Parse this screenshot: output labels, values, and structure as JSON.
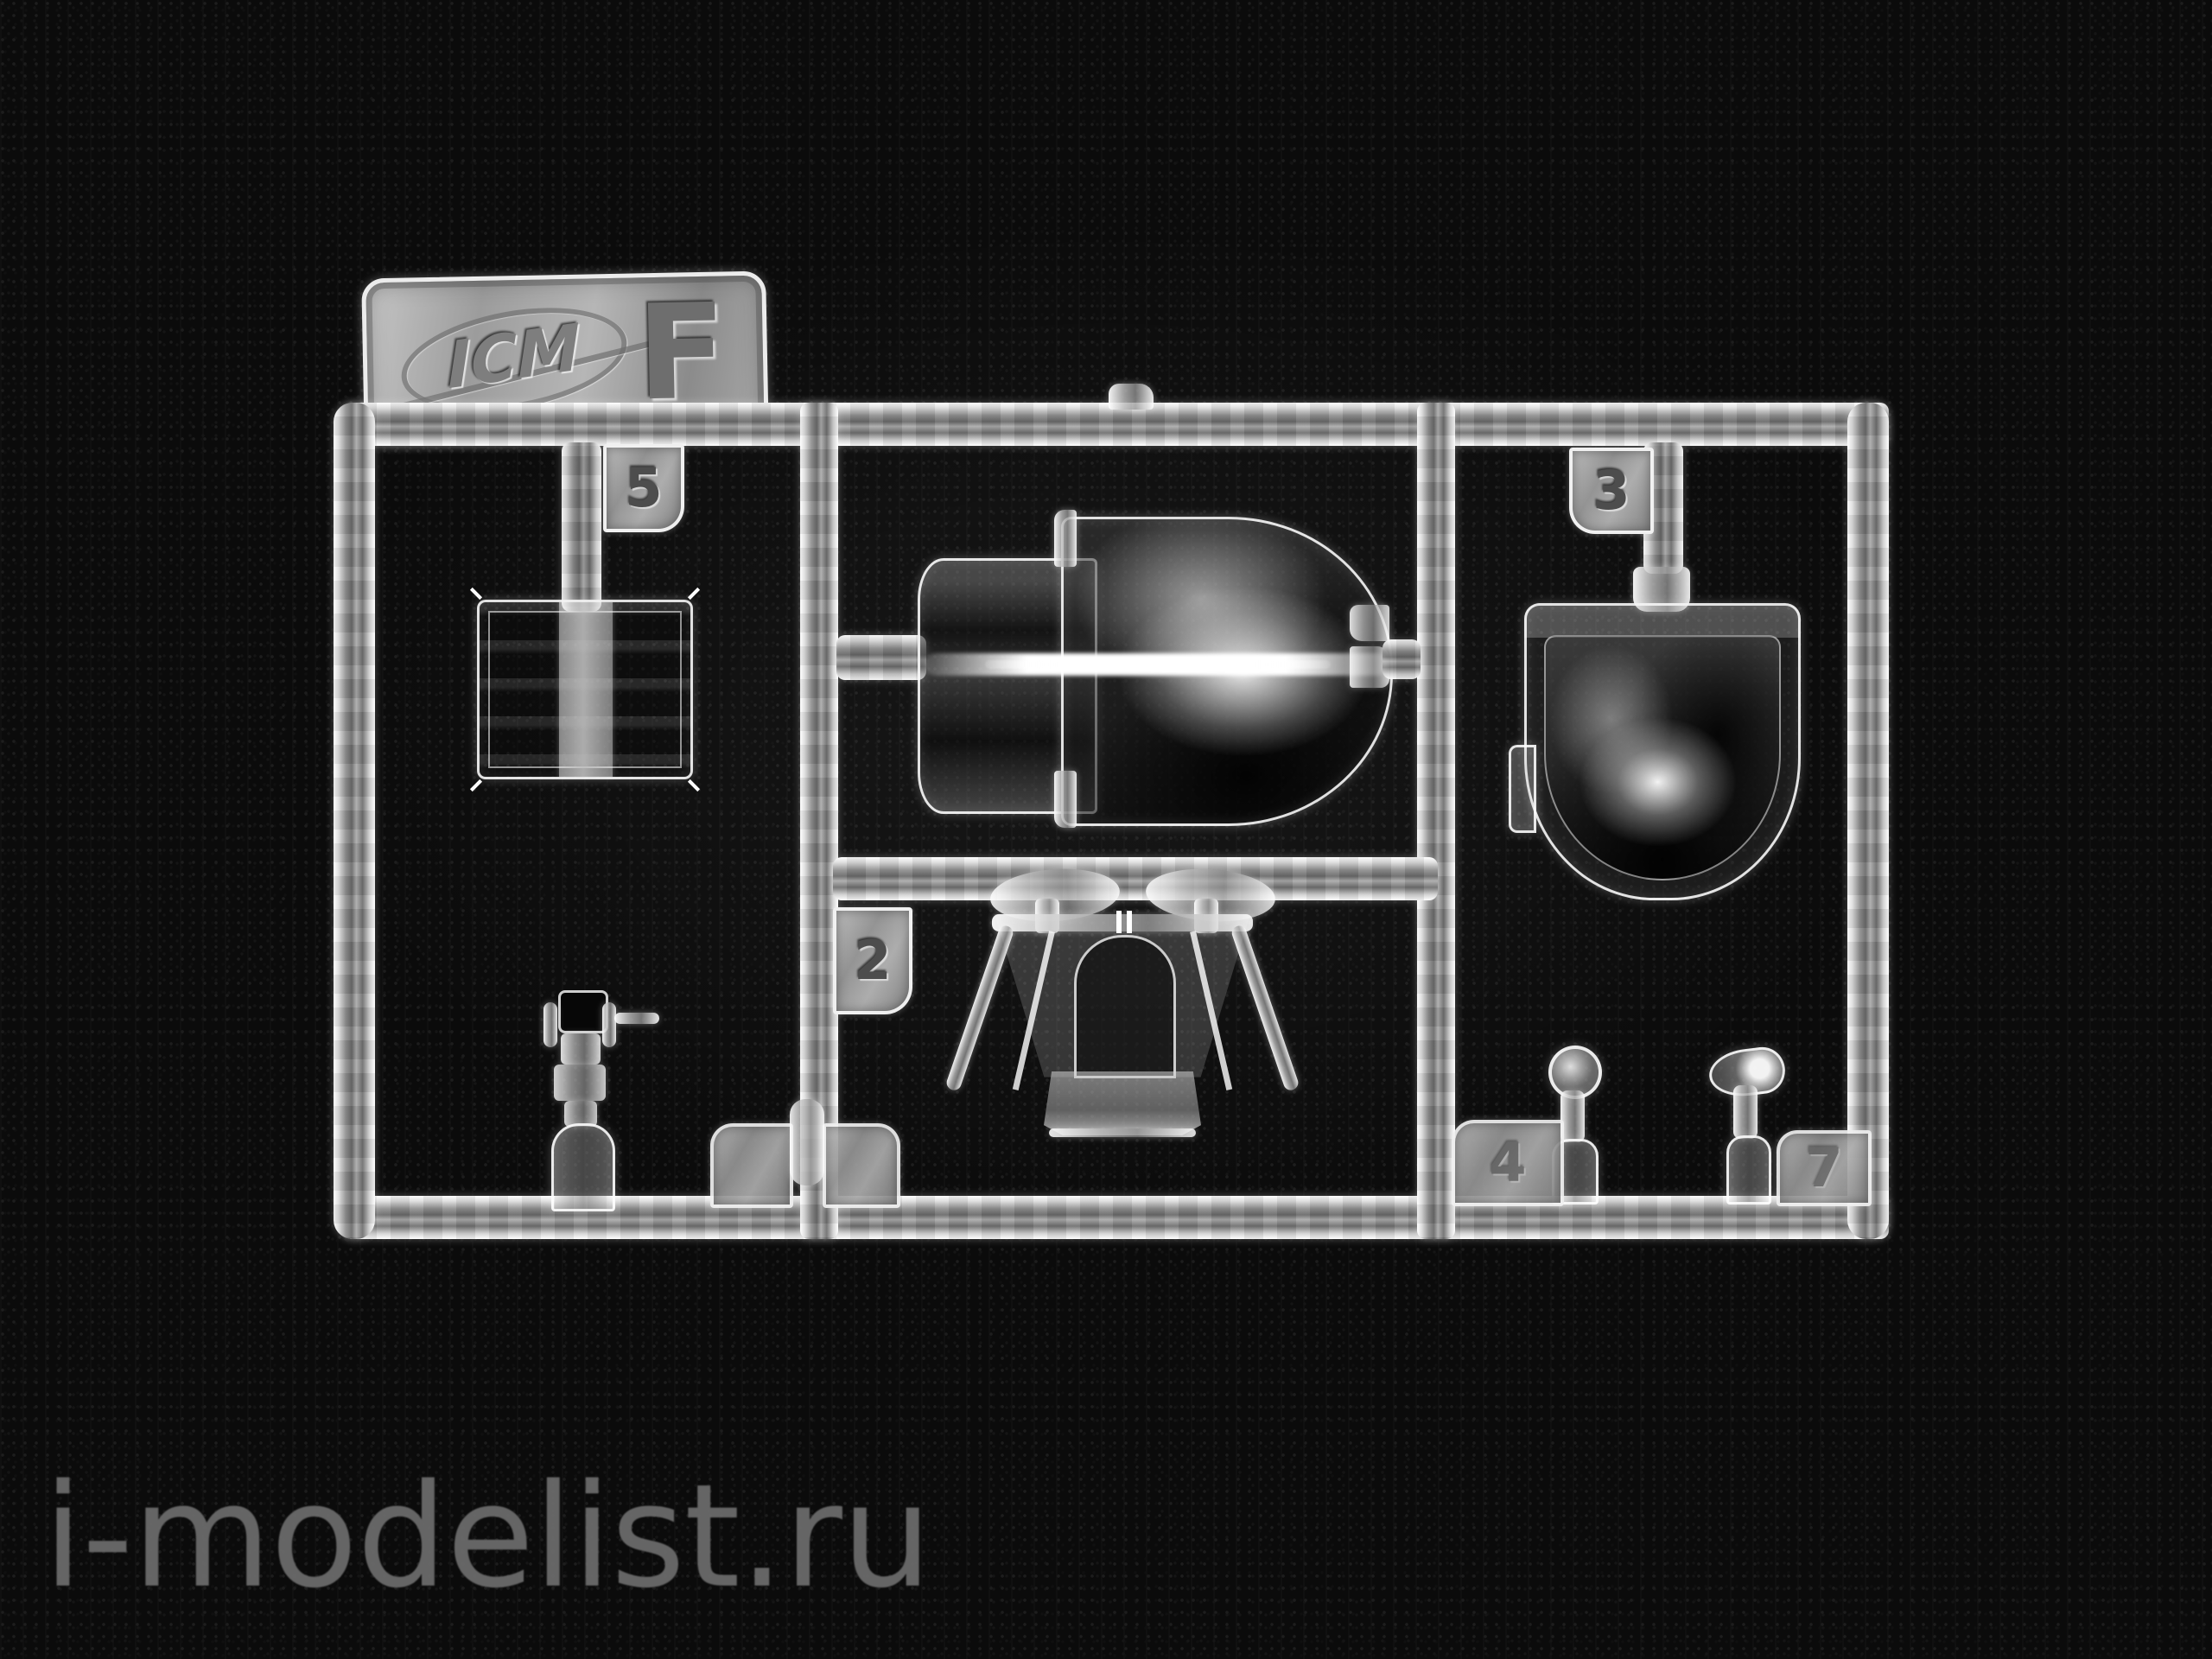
{
  "scene": {
    "type": "product-photo",
    "subject": "clear transparent injection-molded parts sprue (runner F) from an ICM plastic model kit, lying on black knit fabric",
    "background": "black textured fabric"
  },
  "watermark": {
    "text": "i-modelist.ru",
    "color": "#6d6d6d"
  },
  "brand_plate": {
    "logo_text": "ICM",
    "sprue_letter": "F"
  },
  "part_tags": {
    "part5": "5",
    "part3": "3",
    "part2": "2",
    "part4": "4",
    "part7": "7"
  },
  "parts_semantic": [
    "square-canopy-section-part-5",
    "main-canopy-with-blown-dome-center",
    "canopy-dome-part-3",
    "windscreen-part-2",
    "gunsight-small-part",
    "round-lens-part-4",
    "teardrop-lens-part-7",
    "two-worn-unreadable-tags-bottom-left"
  ],
  "palette": {
    "background": "#0b0b0b",
    "plastic_highlight": "#ffffff",
    "plastic_mid": "#9a9a9a",
    "plastic_shadow": "#2f2f2f",
    "watermark_gray": "#6d6d6d"
  }
}
